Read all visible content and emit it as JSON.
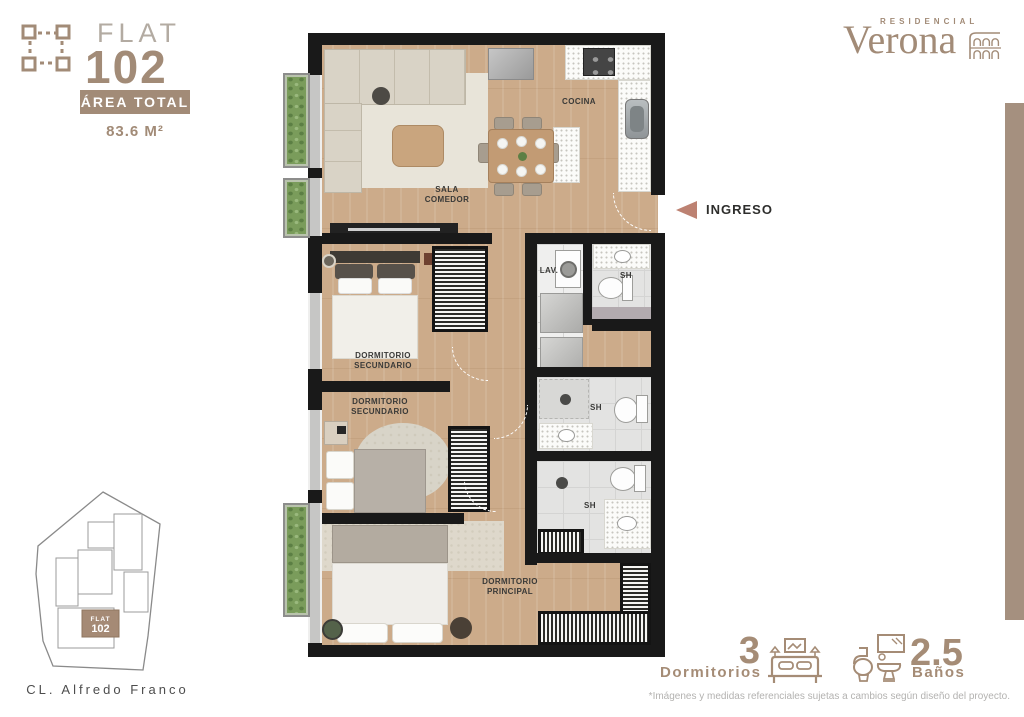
{
  "brand": {
    "residencial": "RESIDENCIAL",
    "name": "Verona"
  },
  "unit": {
    "type_label": "FLAT",
    "number": "102",
    "area_label": "ÁREA TOTAL",
    "area_value": "83.6 M²"
  },
  "floorplan": {
    "labels": {
      "cocina": "COCINA",
      "sala": "SALA\nCOMEDOR",
      "lav": "LAV.",
      "sh": "SH",
      "dorm_sec": "DORMITORIO\nSECUNDARIO",
      "dorm_ppal": "DORMITORIO\nPRINCIPAL",
      "ingreso": "INGRESO"
    }
  },
  "siteplan": {
    "unit_type": "FLAT",
    "unit_number": "102",
    "street": "CL. Alfredo Franco"
  },
  "features": {
    "bedrooms_count": "3",
    "bedrooms_label": "Dormitorios",
    "bathrooms_count": "2.5",
    "bathrooms_label": "Baños"
  },
  "disclaimer": "*Imágenes y medidas referenciales sujetas a cambios según diseño del proyecto.",
  "colors": {
    "accent": "#a28b77",
    "arrow": "#bd8272",
    "bar": "#a5907f",
    "highlight": "#a58a75"
  }
}
